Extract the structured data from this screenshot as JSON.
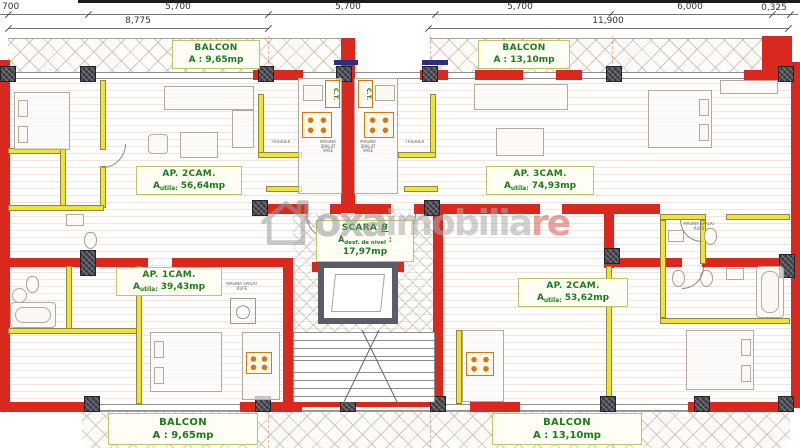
{
  "colors": {
    "wall_red": "#d9291e",
    "partition_yellow": "#f2e136",
    "label_green": "#1c7c1c",
    "watermark_gray": "#9a9a9a",
    "watermark_red": "#d95850"
  },
  "top_dimensions": {
    "row1": [
      "700",
      "5,700",
      "5,700",
      "5,700",
      "6,000",
      "0,325"
    ],
    "row2": [
      "8,775",
      "11,900"
    ]
  },
  "balconies": {
    "top_left": {
      "title": "BALCON",
      "area": "A : 9,65mp"
    },
    "top_right": {
      "title": "BALCON",
      "area": "A : 13,10mp"
    },
    "bottom_left": {
      "title": "BALCON",
      "area": "A : 9,65mp"
    },
    "bottom_right": {
      "title": "BALCON",
      "area": "A : 13,10mp"
    }
  },
  "apartments": {
    "left_upper": {
      "name": "AP. 2CAM.",
      "area_prefix": "A",
      "area_sub": "utila:",
      "area_value": "56,64mp"
    },
    "right_upper": {
      "name": "AP. 3CAM.",
      "area_prefix": "A",
      "area_sub": "utila:",
      "area_value": "74,93mp"
    },
    "left_lower": {
      "name": "AP. 1CAM.",
      "area_prefix": "A",
      "area_sub": "utila:",
      "area_value": "39,43mp"
    },
    "right_lower": {
      "name": "AP. 2CAM.",
      "area_prefix": "A",
      "area_sub": "utila:",
      "area_value": "53,62mp"
    }
  },
  "staircase": {
    "name": "SCARA",
    "letter": "B",
    "area_prefix": "A",
    "area_sub": "desf. de nivel",
    "area_colon": ":",
    "area_value": "17,97mp"
  },
  "equipment_labels": {
    "ct": "C.T.",
    "fridge": "FRIGIDER",
    "dishwasher": "MASINA SPALAT VASE",
    "washer": "MASINA SPALAT RUFE"
  },
  "watermark": {
    "logo": "oxa",
    "gray": "imobilia",
    "red": "re"
  }
}
